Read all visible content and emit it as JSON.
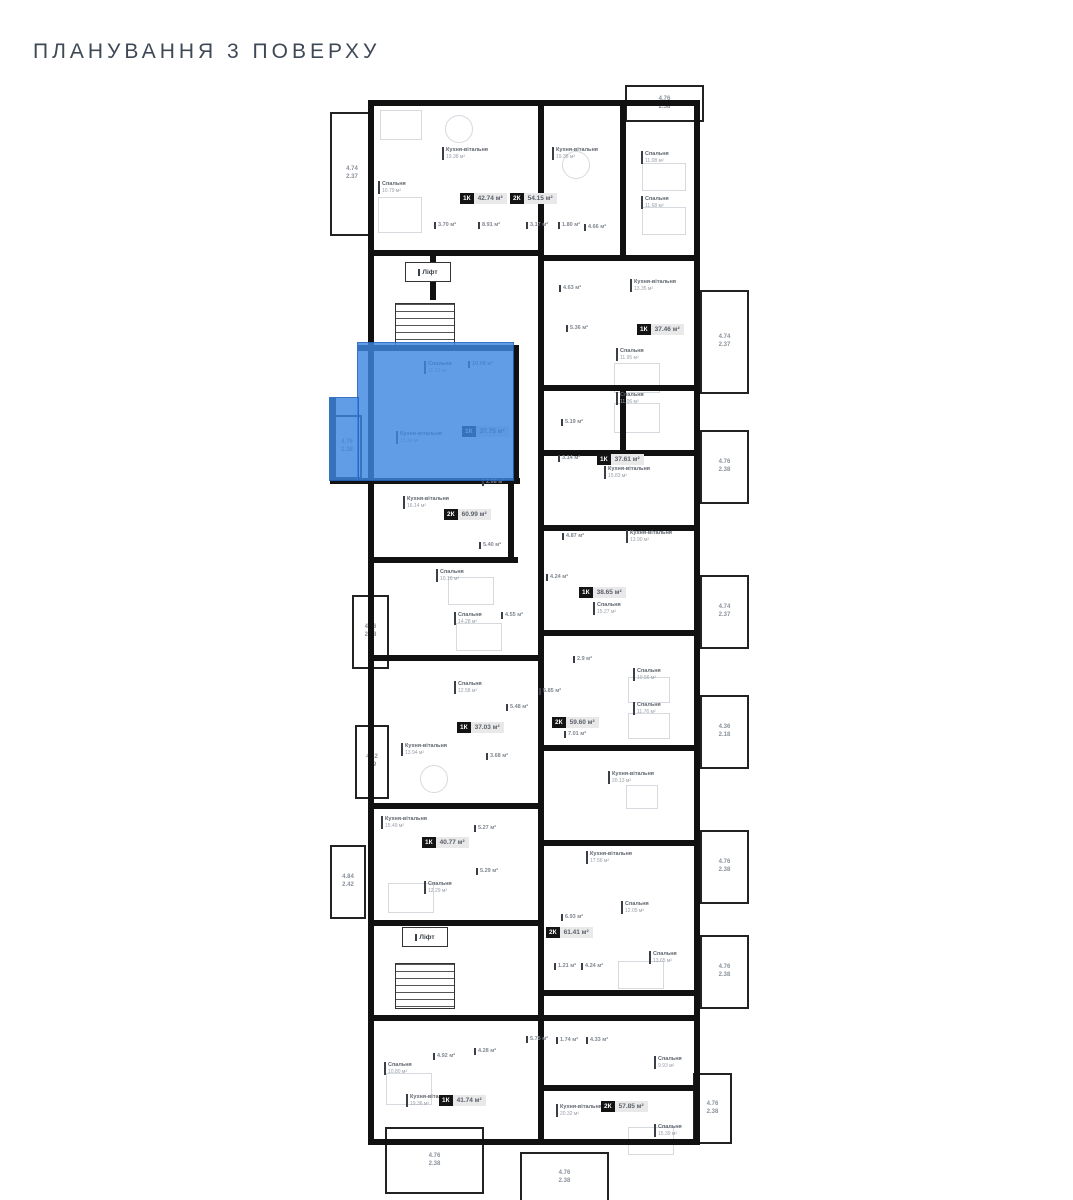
{
  "title": "ПЛАНУВАННЯ 3 ПОВЕРХУ",
  "unit": "м²",
  "highlight_color": "#3e86e2",
  "elevator": {
    "label": "Ліфт",
    "positions": [
      {
        "x": 75,
        "y": 177,
        "w": 44,
        "h": 18
      },
      {
        "x": 72,
        "y": 842,
        "w": 44,
        "h": 18
      }
    ]
  },
  "selected_apartment": {
    "type": "1К",
    "area": "37.75 м²"
  },
  "apartments": [
    {
      "type": "1К",
      "area": "42.74 м²",
      "x": 130,
      "y": 108,
      "highlighted": false
    },
    {
      "type": "2К",
      "area": "54.15 м²",
      "x": 180,
      "y": 108,
      "highlighted": false
    },
    {
      "type": "1К",
      "area": "37.46 м²",
      "x": 307,
      "y": 239,
      "highlighted": false
    },
    {
      "type": "1К",
      "area": "37.75 м²",
      "x": 132,
      "y": 341,
      "highlighted": true
    },
    {
      "type": "1К",
      "area": "37.61 м²",
      "x": 267,
      "y": 369,
      "highlighted": false
    },
    {
      "type": "2К",
      "area": "60.99 м²",
      "x": 114,
      "y": 424,
      "highlighted": false
    },
    {
      "type": "1К",
      "area": "38.65 м²",
      "x": 249,
      "y": 502,
      "highlighted": false
    },
    {
      "type": "2К",
      "area": "59.60 м²",
      "x": 222,
      "y": 632,
      "highlighted": false
    },
    {
      "type": "1К",
      "area": "37.03 м²",
      "x": 127,
      "y": 637,
      "highlighted": false
    },
    {
      "type": "1К",
      "area": "40.77 м²",
      "x": 92,
      "y": 752,
      "highlighted": false
    },
    {
      "type": "2К",
      "area": "61.41 м²",
      "x": 216,
      "y": 842,
      "highlighted": false
    },
    {
      "type": "1К",
      "area": "41.74 м²",
      "x": 109,
      "y": 1010,
      "highlighted": false
    },
    {
      "type": "2К",
      "area": "57.85 м²",
      "x": 271,
      "y": 1016,
      "highlighted": false
    }
  ],
  "rooms": [
    {
      "name": "Кухня-вітальня",
      "area": "19.38 м²",
      "x": 112,
      "y": 62
    },
    {
      "name": "Спальня",
      "area": "10.79 м²",
      "x": 48,
      "y": 96
    },
    {
      "name": "",
      "area": "3.70 м²",
      "x": 104,
      "y": 137
    },
    {
      "name": "",
      "area": "8.91 м²",
      "x": 148,
      "y": 137
    },
    {
      "name": "Кухня-вітальня",
      "area": "19.38 м²",
      "x": 222,
      "y": 62
    },
    {
      "name": "",
      "area": "3.17 м²",
      "x": 196,
      "y": 137
    },
    {
      "name": "",
      "area": "1.80 м²",
      "x": 228,
      "y": 137
    },
    {
      "name": "",
      "area": "4.66 м²",
      "x": 254,
      "y": 139
    },
    {
      "name": "Спальня",
      "area": "11.08 м²",
      "x": 311,
      "y": 66
    },
    {
      "name": "Спальня",
      "area": "11.68 м²",
      "x": 311,
      "y": 111
    },
    {
      "name": "",
      "area": "4.63 м²",
      "x": 229,
      "y": 200
    },
    {
      "name": "Кухня-вітальня",
      "area": "13.35 м²",
      "x": 300,
      "y": 194
    },
    {
      "name": "",
      "area": "5.36 м²",
      "x": 236,
      "y": 240
    },
    {
      "name": "Спальня",
      "area": "11.95 м²",
      "x": 286,
      "y": 263
    },
    {
      "name": "Спальня",
      "area": "11.06 м²",
      "x": 286,
      "y": 307
    },
    {
      "name": "",
      "area": "5.19 м²",
      "x": 231,
      "y": 334
    },
    {
      "name": "",
      "area": "3.14 м²",
      "x": 228,
      "y": 370
    },
    {
      "name": "Кухня-вітальня",
      "area": "15.83 м²",
      "x": 274,
      "y": 381
    },
    {
      "name": "Кухня-вітальня",
      "area": "16.14 м²",
      "x": 73,
      "y": 411
    },
    {
      "name": "",
      "area": "2.08 м²",
      "x": 152,
      "y": 394
    },
    {
      "name": "",
      "area": "5.40 м²",
      "x": 149,
      "y": 457
    },
    {
      "name": "Спальня",
      "area": "10.16 м²",
      "x": 106,
      "y": 484
    },
    {
      "name": "",
      "area": "4.24 м²",
      "x": 216,
      "y": 489
    },
    {
      "name": "Спальня",
      "area": "14.28 м²",
      "x": 124,
      "y": 527
    },
    {
      "name": "",
      "area": "4.55 м²",
      "x": 171,
      "y": 527
    },
    {
      "name": "",
      "area": "4.87 м²",
      "x": 232,
      "y": 448
    },
    {
      "name": "Кухня-вітальня",
      "area": "13.90 м²",
      "x": 296,
      "y": 445
    },
    {
      "name": "Спальня",
      "area": "15.27 м²",
      "x": 263,
      "y": 517
    },
    {
      "name": "",
      "area": "2.9 м²",
      "x": 243,
      "y": 571
    },
    {
      "name": "Спальня",
      "area": "10.56 м²",
      "x": 303,
      "y": 583
    },
    {
      "name": "Спальня",
      "area": "11.76 м²",
      "x": 303,
      "y": 617
    },
    {
      "name": "",
      "area": "5.85 м²",
      "x": 209,
      "y": 603
    },
    {
      "name": "",
      "area": "7.01 м²",
      "x": 234,
      "y": 646
    },
    {
      "name": "Спальня",
      "area": "12.58 м²",
      "x": 124,
      "y": 596
    },
    {
      "name": "",
      "area": "5.48 м²",
      "x": 176,
      "y": 619
    },
    {
      "name": "Кухня-вітальня",
      "area": "13.94 м²",
      "x": 71,
      "y": 658
    },
    {
      "name": "",
      "area": "3.68 м²",
      "x": 156,
      "y": 668
    },
    {
      "name": "Кухня-вітальня",
      "area": "20.13 м²",
      "x": 278,
      "y": 686
    },
    {
      "name": "Кухня-вітальня",
      "area": "15.49 м²",
      "x": 51,
      "y": 731
    },
    {
      "name": "",
      "area": "5.27 м²",
      "x": 144,
      "y": 740
    },
    {
      "name": "",
      "area": "5.29 м²",
      "x": 146,
      "y": 783
    },
    {
      "name": "Спальня",
      "area": "12.29 м²",
      "x": 94,
      "y": 796
    },
    {
      "name": "Кухня-вітальня",
      "area": "17.56 м²",
      "x": 256,
      "y": 766
    },
    {
      "name": "Спальня",
      "area": "12.05 м²",
      "x": 291,
      "y": 816
    },
    {
      "name": "",
      "area": "6.93 м²",
      "x": 231,
      "y": 829
    },
    {
      "name": "",
      "area": "1.21 м²",
      "x": 224,
      "y": 878
    },
    {
      "name": "",
      "area": "4.24 м²",
      "x": 251,
      "y": 878
    },
    {
      "name": "Спальня",
      "area": "13.65 м²",
      "x": 319,
      "y": 866
    },
    {
      "name": "",
      "area": "1.74 м²",
      "x": 226,
      "y": 952
    },
    {
      "name": "",
      "area": "4.33 м²",
      "x": 256,
      "y": 952
    },
    {
      "name": "",
      "area": "5.75 м²",
      "x": 196,
      "y": 951
    },
    {
      "name": "Спальня",
      "area": "9.93 м²",
      "x": 324,
      "y": 971
    },
    {
      "name": "Спальня",
      "area": "10.80 м²",
      "x": 54,
      "y": 977
    },
    {
      "name": "",
      "area": "4.92 м²",
      "x": 103,
      "y": 968
    },
    {
      "name": "",
      "area": "4.28 м²",
      "x": 144,
      "y": 963
    },
    {
      "name": "Кухня-вітальня",
      "area": "19.36 м²",
      "x": 76,
      "y": 1009
    },
    {
      "name": "Кухня-вітальня",
      "area": "20.32 м²",
      "x": 226,
      "y": 1019
    },
    {
      "name": "Спальня",
      "area": "15.39 м²",
      "x": 324,
      "y": 1039
    },
    {
      "name": "Спальня",
      "area": "11.12 м²",
      "x": 94,
      "y": 276
    },
    {
      "name": "",
      "area": "10.08 м²",
      "x": 138,
      "y": 276
    },
    {
      "name": "Кухня-вітальня",
      "area": "15.14 м²",
      "x": 66,
      "y": 346
    }
  ],
  "balconies": [
    {
      "l1": "4.74",
      "l2": "2.37",
      "x": 0,
      "y": 27,
      "w": 40,
      "h": 120
    },
    {
      "l1": "4.76",
      "l2": "2.58",
      "x": 295,
      "y": 0,
      "w": 75,
      "h": 33
    },
    {
      "l1": "4.74",
      "l2": "2.37",
      "x": 370,
      "y": 205,
      "w": 45,
      "h": 100
    },
    {
      "l1": "4.76",
      "l2": "2.38",
      "x": 370,
      "y": 345,
      "w": 45,
      "h": 70
    },
    {
      "l1": "4.76",
      "l2": "2.38",
      "x": 2,
      "y": 330,
      "w": 26,
      "h": 60
    },
    {
      "l1": "4.76",
      "l2": "2.38",
      "x": 22,
      "y": 510,
      "w": 33,
      "h": 70
    },
    {
      "l1": "4.74",
      "l2": "2.37",
      "x": 370,
      "y": 490,
      "w": 45,
      "h": 70
    },
    {
      "l1": "4.22",
      "l2": "2.9",
      "x": 25,
      "y": 640,
      "w": 30,
      "h": 70
    },
    {
      "l1": "4.36",
      "l2": "2.18",
      "x": 370,
      "y": 610,
      "w": 45,
      "h": 70
    },
    {
      "l1": "4.84",
      "l2": "2.42",
      "x": 0,
      "y": 760,
      "w": 32,
      "h": 70
    },
    {
      "l1": "4.76",
      "l2": "2.38",
      "x": 370,
      "y": 745,
      "w": 45,
      "h": 70
    },
    {
      "l1": "4.76",
      "l2": "2.38",
      "x": 370,
      "y": 850,
      "w": 45,
      "h": 70
    },
    {
      "l1": "4.76",
      "l2": "2.38",
      "x": 363,
      "y": 988,
      "w": 35,
      "h": 67
    },
    {
      "l1": "4.76",
      "l2": "2.38",
      "x": 55,
      "y": 1042,
      "w": 95,
      "h": 63
    },
    {
      "l1": "4.76",
      "l2": "2.38",
      "x": 190,
      "y": 1067,
      "w": 85,
      "h": 48
    }
  ]
}
